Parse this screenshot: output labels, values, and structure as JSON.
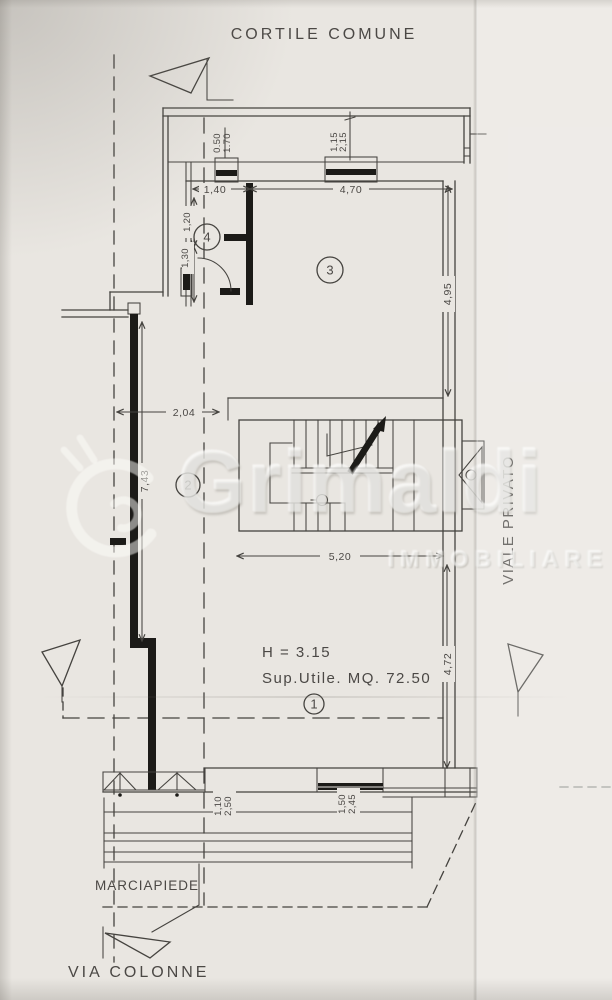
{
  "plan": {
    "streets": {
      "top": "CORTILE COMUNE",
      "bottom": "VIA COLONNE",
      "right": "VIALE PRIVATO",
      "sidewalk": "MARCIAPIEDE"
    },
    "notes": {
      "height": "H = 3.15",
      "surface": "Sup.Utile. MQ. 72.50"
    },
    "rooms": [
      {
        "id": "1"
      },
      {
        "id": "2"
      },
      {
        "id": "3"
      },
      {
        "id": "4"
      }
    ],
    "dims": {
      "top_window_left": {
        "w": "0.50",
        "h": "1.70"
      },
      "top_window_mid": {
        "w": "1,15",
        "h": "2,15"
      },
      "room4_top_width": "1,40",
      "room3_top_width": "4,70",
      "room4_upper": "1,20",
      "room4_lower": "1,30",
      "room3_depth": "4,95",
      "corridor_width": "2,04",
      "left_wall_length": "7,43",
      "stair_block_width": "5,20",
      "room1_depth": "4,72",
      "front_door_left": {
        "w": "1,10",
        "h": "2,50"
      },
      "front_window_right": {
        "w": "1,50",
        "h": "2,45"
      }
    },
    "watermark": {
      "brand": "Grimaldi",
      "sub": "IMMOBILIARE"
    },
    "colors": {
      "paper": "#e9e6e1",
      "ink": "#45433f",
      "wall": "#1c1b18"
    }
  }
}
